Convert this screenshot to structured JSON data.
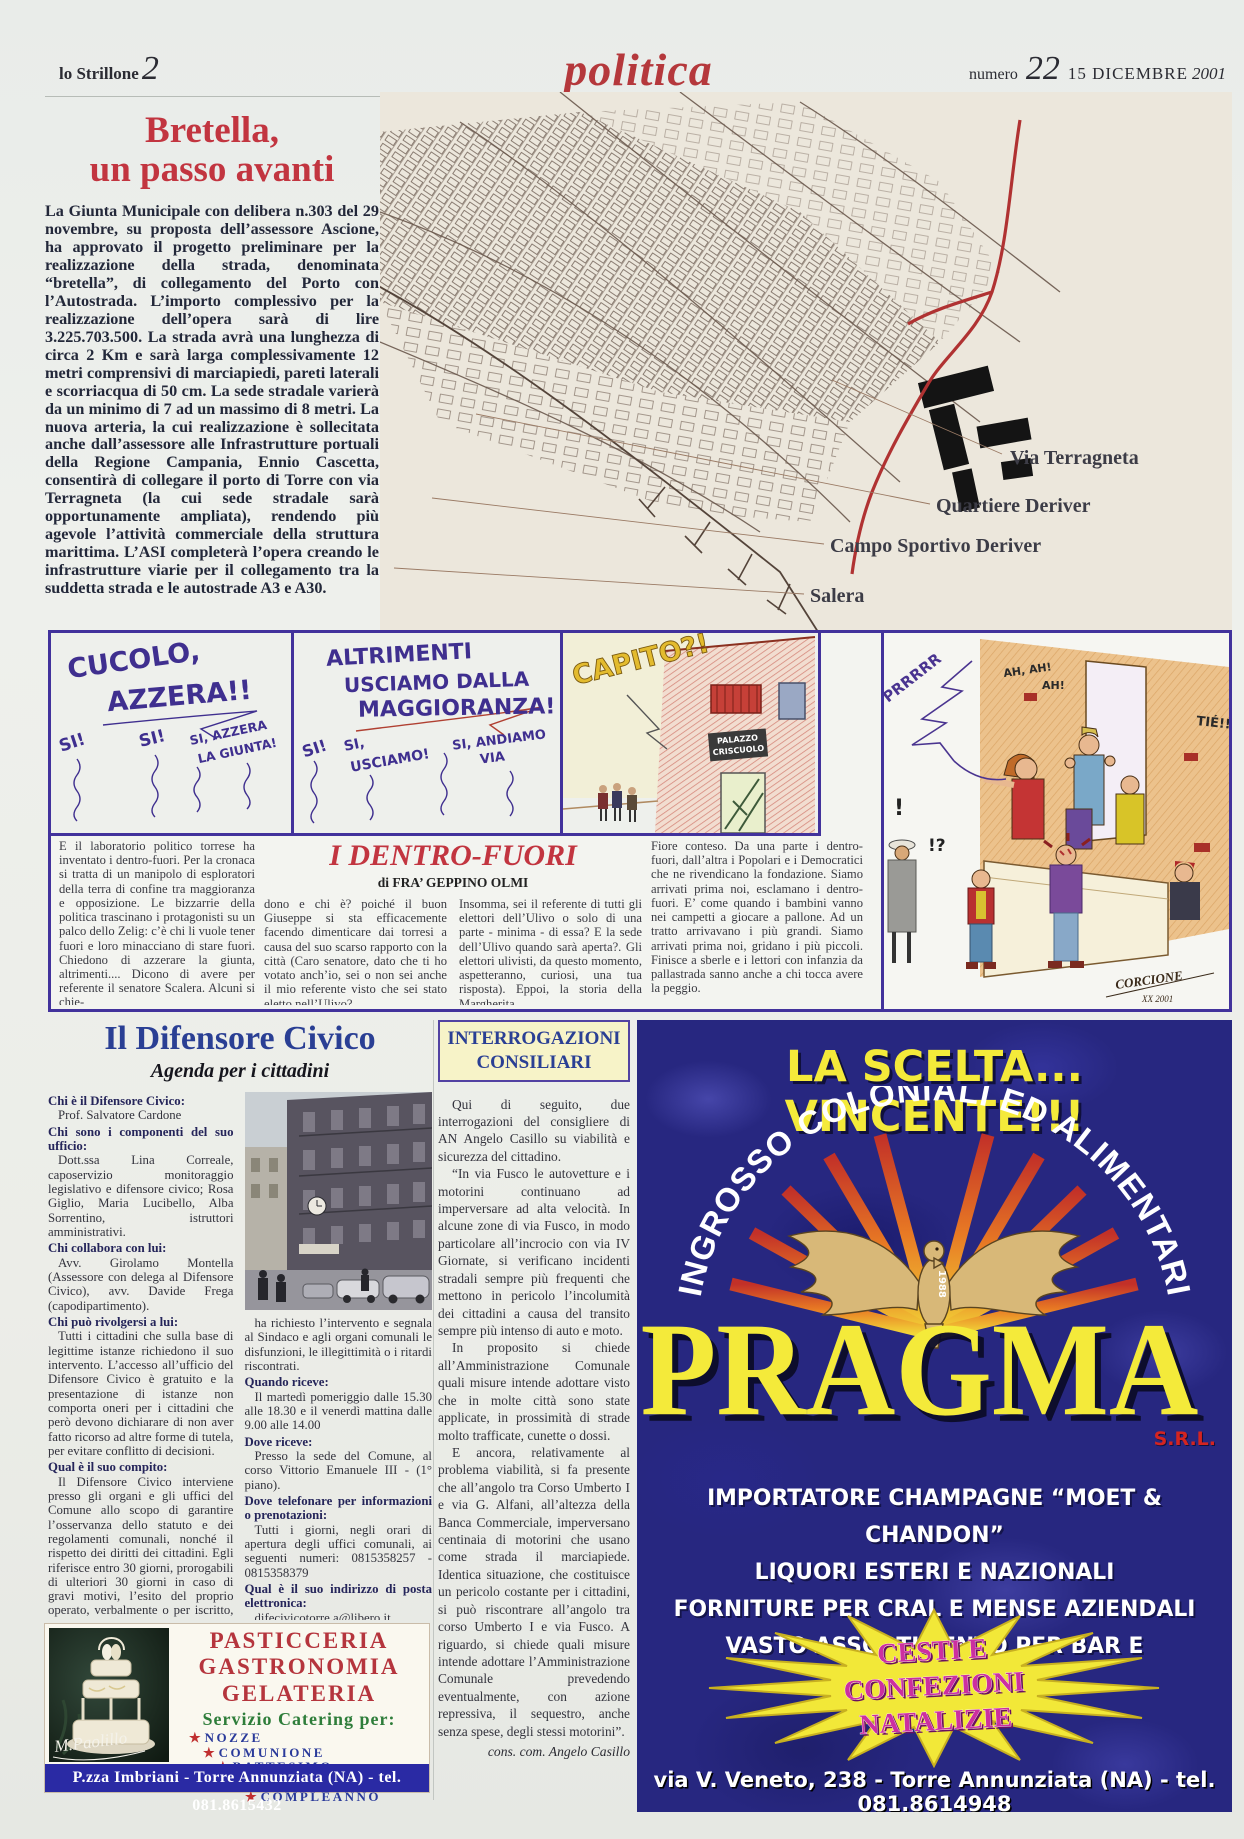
{
  "masthead": {
    "name": "lo Strillone",
    "page": "2",
    "section": "politica",
    "numero_label": "numero",
    "numero": "22",
    "date": "15 DICEMBRE",
    "year": "2001"
  },
  "bretella": {
    "title1": "Bretella,",
    "title2": "un passo avanti",
    "body": "La Giunta Municipale con delibera n.303 del 29 novembre, su proposta dell’assessore Ascione,  ha approvato il progetto preliminare per la realizzazione della strada, denominata “bretella”, di collegamento del Porto con l’Autostrada. L’importo complessivo per la realizzazione dell’opera sarà di lire 3.225.703.500. La strada avrà una lunghezza di circa 2 Km e sarà larga complessivamente 12 metri comprensivi di marciapiedi, pareti laterali e scorriacqua di 50 cm. La sede stradale varierà da un minimo di 7 ad un massimo di 8 metri. La nuova arteria, la cui realizzazione è sollecitata anche dall’assessore alle Infrastrutture portuali della Regione Campania, Ennio Cascetta,  consentirà di collegare il porto di Torre con via Terragneta (la cui sede stradale sarà opportunamente ampliata), rendendo più agevole l’attività commerciale della struttura marittima. L’ASI completerà l’opera creando le infrastrutture viarie per il collegamento tra la suddetta strada e le autostrade A3 e A30."
  },
  "map": {
    "label1": "Via Terragneta",
    "label2": "Quartiere Deriver",
    "label3": "Campo Sportivo Deriver",
    "label4": "Salera"
  },
  "comic": {
    "p1_line1": "CUCOLO,",
    "p1_line2": "AZZERA!!",
    "p1_r1": "SI!",
    "p1_r2": "SI!",
    "p1_r3a": "SI, AZZERA",
    "p1_r3b": "LA GIUNTA!",
    "p2_line1": "ALTRIMENTI",
    "p2_line2": "USCIAMO DALLA",
    "p2_line3": "MAGGIORANZA!",
    "p2_r1": "SI!",
    "p2_r2a": "SI,",
    "p2_r2b": "USCIAMO!",
    "p2_r3a": "SI, ANDIAMO",
    "p2_r3b": "VIA",
    "p3_shout": "CAPITO?!",
    "p3_sign1": "PALAZZO",
    "p3_sign2": "CRISCUOLO",
    "p4_prr": "PRRRRR",
    "p4_ah1": "AH, AH!",
    "p4_ah2": "AH!",
    "p4_tie": "TIÉ!!",
    "p4_bang": "!",
    "p4_intbang": "!?",
    "p4_sig": "CORCIONE",
    "p4_sigyear": "XX 2001"
  },
  "dentrofuori": {
    "title": "I DENTRO-FUORI",
    "byline": "di FRA’ GEPPINO OLMI",
    "col1": "E il laboratorio  politico torrese ha inventato i dentro-fuori. Per la cronaca si tratta di un manipolo di esploratori  della terra di confine tra maggioranza e opposizione. Le bizzarrie della politica trascinano i protagonisti su un palco dello Zelig: c’è chi li vuole tener fuori e loro minacciano di stare fuori. Chiedono di azzerare la giunta, altrimenti.... Dicono di avere per referente il senatore Scalera. Alcuni si chie-",
    "col2": "dono e chi è? poiché il buon Giuseppe si sta efficacemente facendo dimenticare dai torresi a causa del suo scarso rapporto con la città (Caro senatore, dato che ti ho votato anch’io, sei o non sei anche il mio referente visto che sei stato eletto nell’Ulivo?",
    "col3": "Insomma, sei il referente di tutti gli elettori dell’Ulivo o solo di una parte - minima - di essa? E la sede dell’Ulivo quando sarà aperta?. Gli elettori ulivisti, da questo momento, aspetteranno, curiosi, una tua risposta). Eppoi, la storia della Margherita.",
    "col4": "Fiore conteso. Da una parte i  dentro-fuori, dall’altra i Popolari e i Democratici che ne rivendicano la fondazione. Siamo arrivati prima noi, esclamano i dentro-fuori. E’ come quando i bambini vanno nei campetti a giocare a pallone. Ad un tratto arrivavano i più grandi. Siamo arrivati prima noi, gridano i più piccoli. Finisce a sberle e i lettori con infanzia da pallastrada sanno anche a chi tocca avere la peggio."
  },
  "difensore": {
    "title": "Il Difensore Civico",
    "subtitle": "Agenda per i cittadini",
    "q1": "Chi è il Difensore Civico:",
    "a1": "Prof. Salvatore Cardone",
    "q2": "Chi sono i componenti del suo ufficio:",
    "a2": "Dott.ssa Lina Correale, caposervizio monitoraggio legislativo e difensore civico; Rosa Giglio, Maria Lucibello, Alba Sorrentino, istruttori amministrativi.",
    "q3": "Chi collabora con lui:",
    "a3": "Avv. Girolamo Montella (Assessore con delega al Difensore Civico), avv. Davide Frega (capodipartimento).",
    "q4": "Chi può rivolgersi a lui:",
    "a4": "Tutti i cittadini che sulla base di legittime istanze richiedono il suo intervento. L’accesso all’ufficio del Difensore Civico è gratuito e la presentazione di istanze non comporta oneri per i cittadini che però devono dichiarare di non aver fatto ricorso ad altre forme di tutela, per evitare conflitto di decisioni.",
    "q5": "Qual è il suo compito:",
    "a5": "Il Difensore Civico interviene presso gli organi e gli uffici del Comune allo scopo di garantire l’osservanza dello statuto e dei regolamenti comunali, nonché il rispetto dei diritti dei cittadini. Egli riferisce entro 30 giorni, prorogabili di ulteriori 30 giorni in caso di gravi motivi, l’esito del proprio operato, verbalmente o per iscritto, al cittadino che gli",
    "a5b": "ha richiesto l’intervento e segnala al Sindaco e agli organi comunali le disfunzioni, le illegittimità o i ritardi riscontrati.",
    "q6": "Quando riceve:",
    "a6": "Il martedì pomeriggio dalle 15.30 alle 18.30 e il venerdì mattina dalle 9.00 alle 14.00",
    "q7": "Dove riceve:",
    "a7": "Presso la sede del Comune, al corso Vittorio Emanuele III - (1° piano).",
    "q8": "Dove telefonare per informazioni o prenotazioni:",
    "a8": "Tutti i giorni, negli orari di apertura degli uffici comunali, ai seguenti numeri: 0815358257 - 0815358379",
    "q9": "Qual è il suo indirizzo di posta elettronica:",
    "a9": "difecivicotorre.a@libero.it"
  },
  "interrogazioni": {
    "header": "INTERROGAZIONI CONSILIARI",
    "p1": "Qui di seguito, due interrogazioni del consigliere di AN Angelo Casillo su viabilità e sicurezza del cittadino.",
    "p2": "“In via Fusco le autovetture e i motorini continuano ad imperversare ad alta velocità. In alcune zone di via Fusco, in modo particolare all’incrocio con via IV Giornate, si verificano incidenti stradali sempre più frequenti che mettono in pericolo l’incolumità dei cittadini a causa del transito sempre più intenso di auto e moto.",
    "p3": "In proposito si chiede all’Amministrazione Comunale quali misure intende adottare visto che in molte città sono state applicate, in prossimità di strade molto trafficate, cunette o dossi.",
    "p4": "E ancora, relativamente al problema viabilità, si fa presente che all’angolo tra Corso Umberto I e via G. Alfani, all’altezza della Banca Commerciale, imperversano centinaia di motorini che usano come strada il marciapiede. Identica situazione, che costituisce un pericolo costante per i cittadini, si può riscontrare all’angolo tra corso Umberto I e via Fusco. A riguardo, si chiede quali misure intende adottare l’Amministrazione Comunale prevedendo eventualmente, con azione repressiva, il sequestro, anche senza spese, degli stessi motorini”.",
    "firma": "cons. com. Angelo Casillo"
  },
  "pragma": {
    "headline": "LA SCELTA... VINCENTE!!!",
    "arch": "INGROSSO COLONIALI ED ALIMENTARI",
    "brand": "PRAGMA",
    "brand_suffix": "S.R.L.",
    "year": "1988",
    "line1": "IMPORTATORE CHAMPAGNE “MOET & CHANDON”",
    "line2": "LIQUORI ESTERI E NAZIONALI",
    "line3": "FORNITURE PER CRAL E MENSE AZIENDALI",
    "line4": "VASTO ASSORTIMENTO PER BAR E PASTICCERIE",
    "burst1": "CESTI E",
    "burst2": "CONFEZIONI",
    "burst3": "NATALIZIE",
    "address": "via V. Veneto, 238 - Torre Annunziata (NA) - tel. 081.8614948"
  },
  "pasticceria": {
    "line1": "PASTICCERIA",
    "line2": "GASTRONOMIA",
    "line3": "GELATERIA",
    "catering": "Servizio Catering per:",
    "s1": "NOZZE",
    "s2": "COMUNIONE",
    "s3": "BATTESIMO",
    "s4": "RICEVIMENTO",
    "s5": "COMPLEANNO",
    "signature": "M.Paolillo",
    "address": "P.zza Imbriani - Torre Annunziata (NA) - tel. 081.8615432"
  }
}
